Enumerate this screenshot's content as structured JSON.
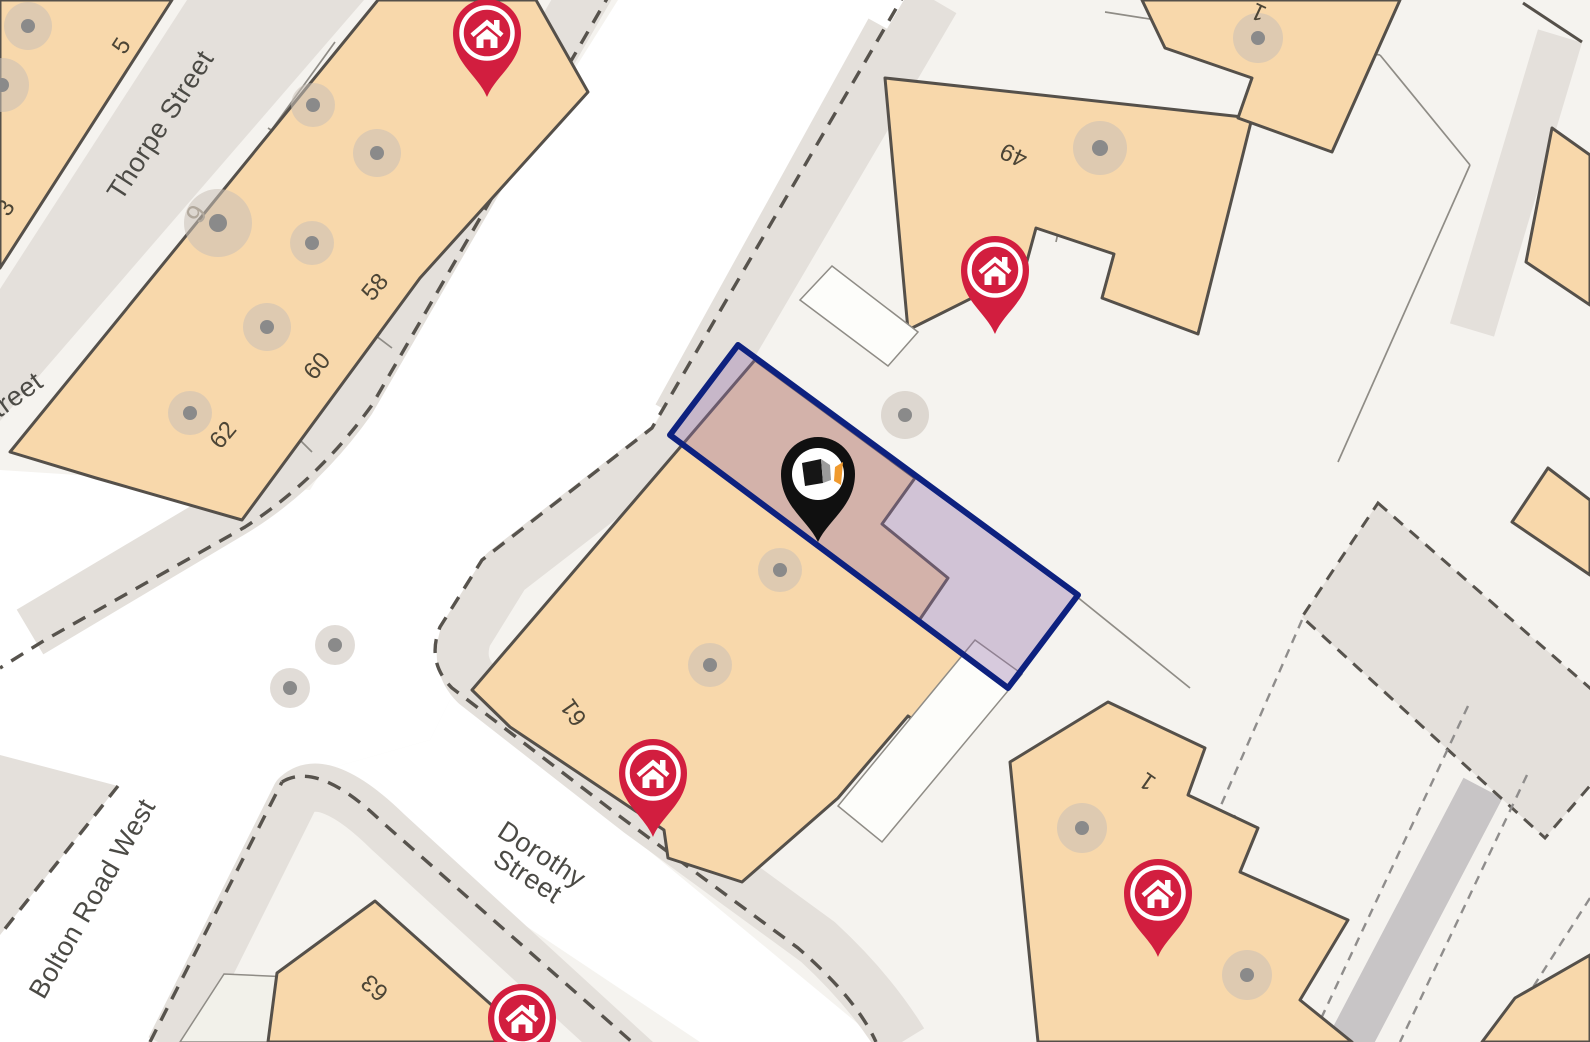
{
  "map": {
    "streets": {
      "thorpe": "Thorpe Street",
      "partial_left": "treet",
      "bolton": "Bolton Road West",
      "dorothy_line1": "Dorothy",
      "dorothy_line2": "Street"
    },
    "house_numbers": {
      "n5": "5",
      "n3": "3",
      "n9": "9",
      "n58": "58",
      "n60": "60",
      "n62": "62",
      "n61": "61",
      "n63": "63",
      "n49": "49",
      "n1": "1",
      "n1_top": "1"
    },
    "markers": {
      "red_listing_pin_count": 5,
      "red_pin_icon": "house-icon",
      "property_pin_icon": "property-logo-pin"
    },
    "colors": {
      "building": "#f8d8ab",
      "building_outline": "#55504a",
      "road_white": "#ffffff",
      "background": "#f5f3ef",
      "pavement": "#e4e0db",
      "alley": "#c8c5c6",
      "dashed_line": "#57534d",
      "parcel_line": "#8f8c86",
      "tree_fill": "#c8c0b7",
      "tree_dot": "#8a8a8a",
      "pin_red": "#d21e3f",
      "highlight_border": "#0d217f",
      "highlight_fill": "#9470aa",
      "logo_orange": "#f09a2e"
    }
  }
}
